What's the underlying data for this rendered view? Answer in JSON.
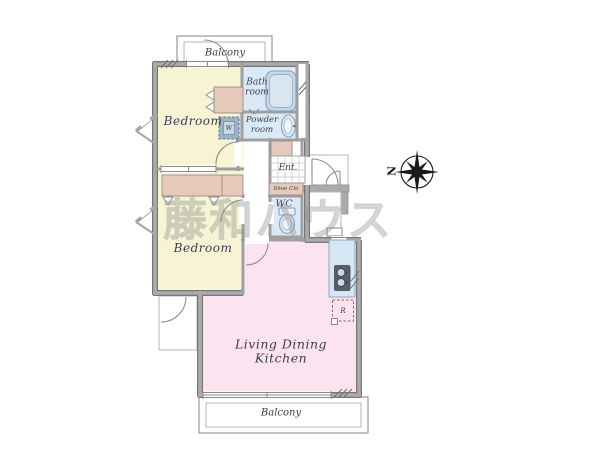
{
  "plan": {
    "watermark": "藤和ハウス",
    "compass_north": "N",
    "labels": {
      "balcony_top": "Balcony",
      "bedroom_top": "Bedroom",
      "bath_room": [
        "Bath",
        "room"
      ],
      "powder_room": [
        "Powder",
        "room"
      ],
      "washer": "W",
      "entrance": "Ent.",
      "shoe_closet": "Shoe Clo",
      "wc": "WC",
      "bedroom_mid": "Bedroom",
      "ldk": [
        "Living Dining",
        "Kitchen"
      ],
      "refrigerator": "R",
      "balcony_bottom": "Balcony"
    }
  },
  "colors": {
    "bedroom_fill": "#f6f4d5",
    "closet_fill": "#e5c9ba",
    "wet_area_fill": "#d9eaf6",
    "ldk_fill": "#fbe4ef",
    "kitchen_fill": "#d4e7f5",
    "wall_gray": "#ababab",
    "wall_edge": "#767676",
    "label_color": "#3d3d52",
    "watermark_gray": "#9a9a9a",
    "compass_black": "#1a1a1a"
  }
}
